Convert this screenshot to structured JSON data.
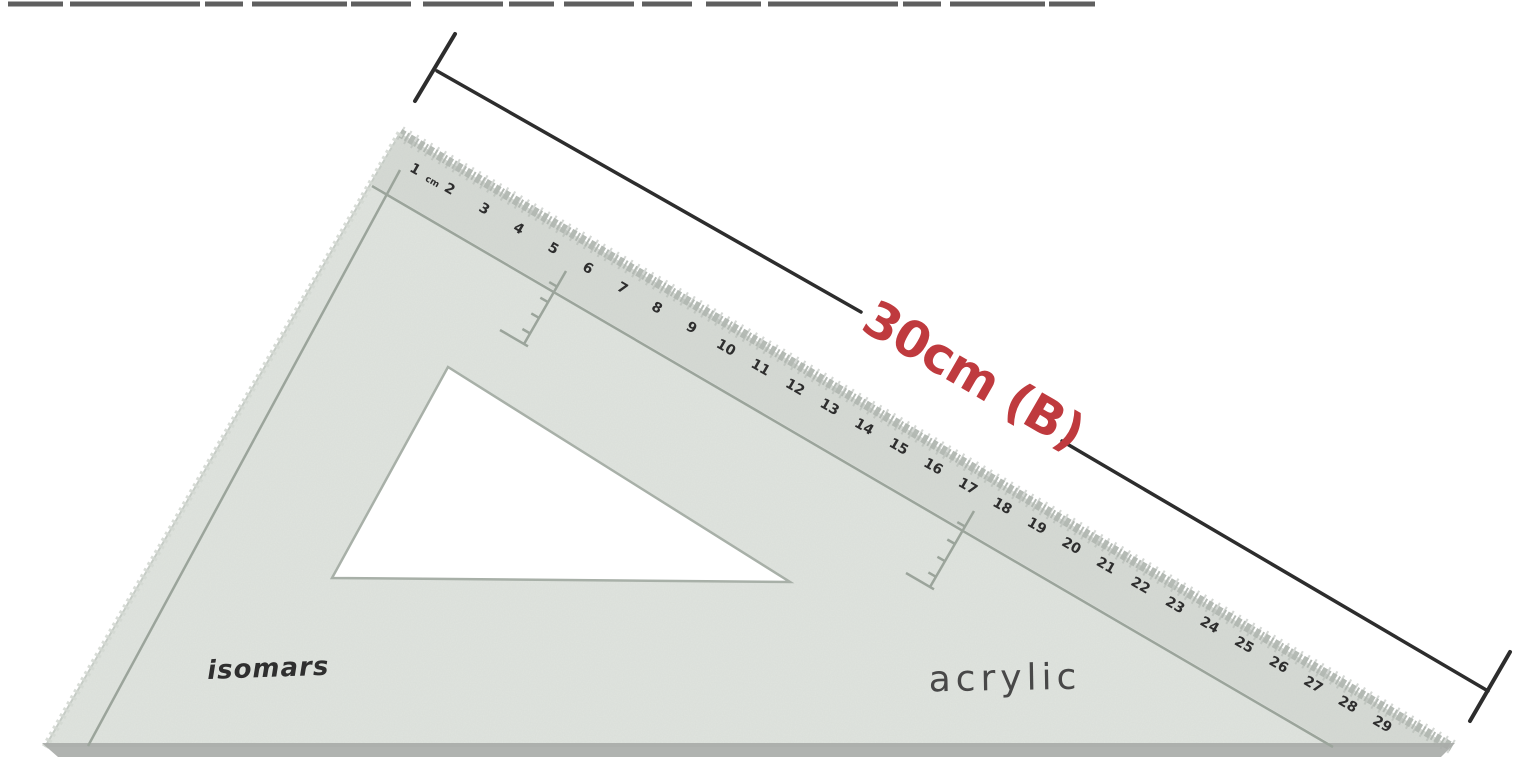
{
  "photo": {
    "brand": "isomars",
    "material": "acrylic",
    "dimension_label": "30cm (B)",
    "ruler": {
      "unit_label": "cm",
      "numbers": [
        1,
        2,
        3,
        4,
        5,
        6,
        7,
        8,
        9,
        10,
        11,
        12,
        13,
        14,
        15,
        16,
        17,
        18,
        19,
        20,
        21,
        22,
        23,
        24,
        25,
        26,
        27,
        28,
        29
      ]
    },
    "colors": {
      "body": "#e0e4df",
      "ruler_band": "#d6dad5",
      "edge_serration": "#b2b8b2",
      "left_edge": "#d4d9d3",
      "inner_line": "#9ba49b",
      "shadow": "#a7aba7",
      "cutout_outline": "#a8b0a8",
      "dimension_line": "#2d2d2d",
      "dimension_text": "#bf3a3e",
      "brand_text": "#2f2f2f",
      "material_text": "#484848",
      "number_text": "#2e2e2e"
    }
  }
}
